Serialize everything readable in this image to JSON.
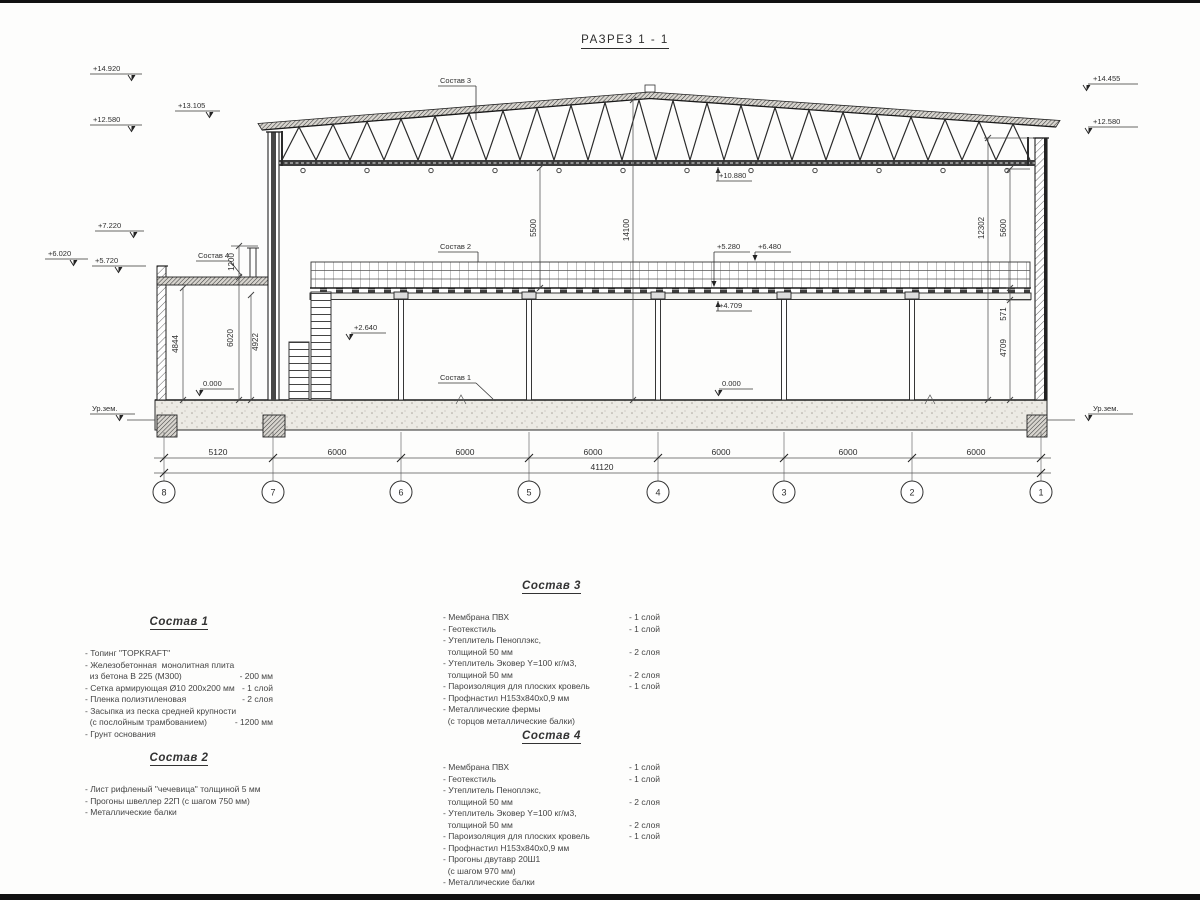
{
  "title": "РАЗРЕЗ 1 - 1",
  "drawing": {
    "elev_left": [
      "+14.920",
      "+13.105",
      "+12.580",
      "+7.220",
      "+6.020",
      "+5.720"
    ],
    "elev_right": [
      "+14.455",
      "+12.580"
    ],
    "elev_inner": [
      "+10.880",
      "+5.280",
      "+6.480",
      "+4.709",
      "+2.640",
      "0.000",
      "0.000"
    ],
    "ground": [
      "Ур.зем.",
      "Ур.зем."
    ],
    "callouts": [
      "Состав 1",
      "Состав 2",
      "Состав 3",
      "Состав 4"
    ],
    "vdims": {
      "d5500": "5500",
      "d14100": "14100",
      "d1200": "1200",
      "d6020": "6020",
      "d4922": "4922",
      "d4844": "4844",
      "d12302": "12302",
      "d5600": "5600",
      "d571": "571",
      "d4709": "4709"
    },
    "hdims": [
      "5120",
      "6000",
      "6000",
      "6000",
      "6000",
      "6000",
      "6000"
    ],
    "total": "41120",
    "axes": [
      "8",
      "7",
      "6",
      "5",
      "4",
      "3",
      "2",
      "1"
    ]
  },
  "notes": {
    "s1": {
      "title": "Состав 1",
      "lines": [
        {
          "t": "- Топинг \"TOPKRAFT\"",
          "v": ""
        },
        {
          "t": "- Железобетонная  монолитная плита",
          "v": ""
        },
        {
          "t": "  из бетона В 225 (М300)",
          "v": "- 200 мм"
        },
        {
          "t": "- Сетка армирующая Ø10 200х200 мм",
          "v": "- 1 слой"
        },
        {
          "t": "- Пленка полиэтиленовая",
          "v": "- 2 слоя"
        },
        {
          "t": "- Засыпка из песка средней крупности",
          "v": ""
        },
        {
          "t": "  (с послойным трамбованием)",
          "v": "- 1200 мм"
        },
        {
          "t": "- Грунт основания",
          "v": ""
        }
      ]
    },
    "s2": {
      "title": "Состав 2",
      "lines": [
        {
          "t": "- Лист рифленый \"чечевица\" толщиной 5 мм",
          "v": ""
        },
        {
          "t": "- Прогоны швеллер 22П (с шагом 750 мм)",
          "v": ""
        },
        {
          "t": "- Металлические балки",
          "v": ""
        }
      ]
    },
    "s3": {
      "title": "Состав 3",
      "lines": [
        {
          "t": "- Мембрана ПВХ",
          "v": "- 1 слой"
        },
        {
          "t": "- Геотекстиль",
          "v": "- 1 слой"
        },
        {
          "t": "- Утеплитель Пеноплэкс,",
          "v": ""
        },
        {
          "t": "  толщиной 50 мм",
          "v": "- 2 слоя"
        },
        {
          "t": "- Утеплитель Эковер Y=100 кг/м3,",
          "v": ""
        },
        {
          "t": "  толщиной 50 мм",
          "v": "- 2 слоя"
        },
        {
          "t": "- Пароизоляция для плоских кровель",
          "v": "- 1 слой"
        },
        {
          "t": "- Профнастил Н153х840х0,9 мм",
          "v": ""
        },
        {
          "t": "- Металлические фермы",
          "v": ""
        },
        {
          "t": "  (с торцов металлические балки)",
          "v": ""
        }
      ]
    },
    "s4": {
      "title": "Состав 4",
      "lines": [
        {
          "t": "- Мембрана ПВХ",
          "v": "- 1 слой"
        },
        {
          "t": "- Геотекстиль",
          "v": "- 1 слой"
        },
        {
          "t": "- Утеплитель Пеноплэкс,",
          "v": ""
        },
        {
          "t": "  толщиной 50 мм",
          "v": "- 2 слоя"
        },
        {
          "t": "- Утеплитель Эковер Y=100 кг/м3,",
          "v": ""
        },
        {
          "t": "  толщиной 50 мм",
          "v": "- 2 слоя"
        },
        {
          "t": "- Пароизоляция для плоских кровель",
          "v": "- 1 слой"
        },
        {
          "t": "- Профнастил Н153х840х0,9 мм",
          "v": ""
        },
        {
          "t": "- Прогоны двутавр 20Ш1",
          "v": ""
        },
        {
          "t": "  (с шагом 970 мм)",
          "v": ""
        },
        {
          "t": "- Металлические балки",
          "v": ""
        }
      ]
    }
  }
}
